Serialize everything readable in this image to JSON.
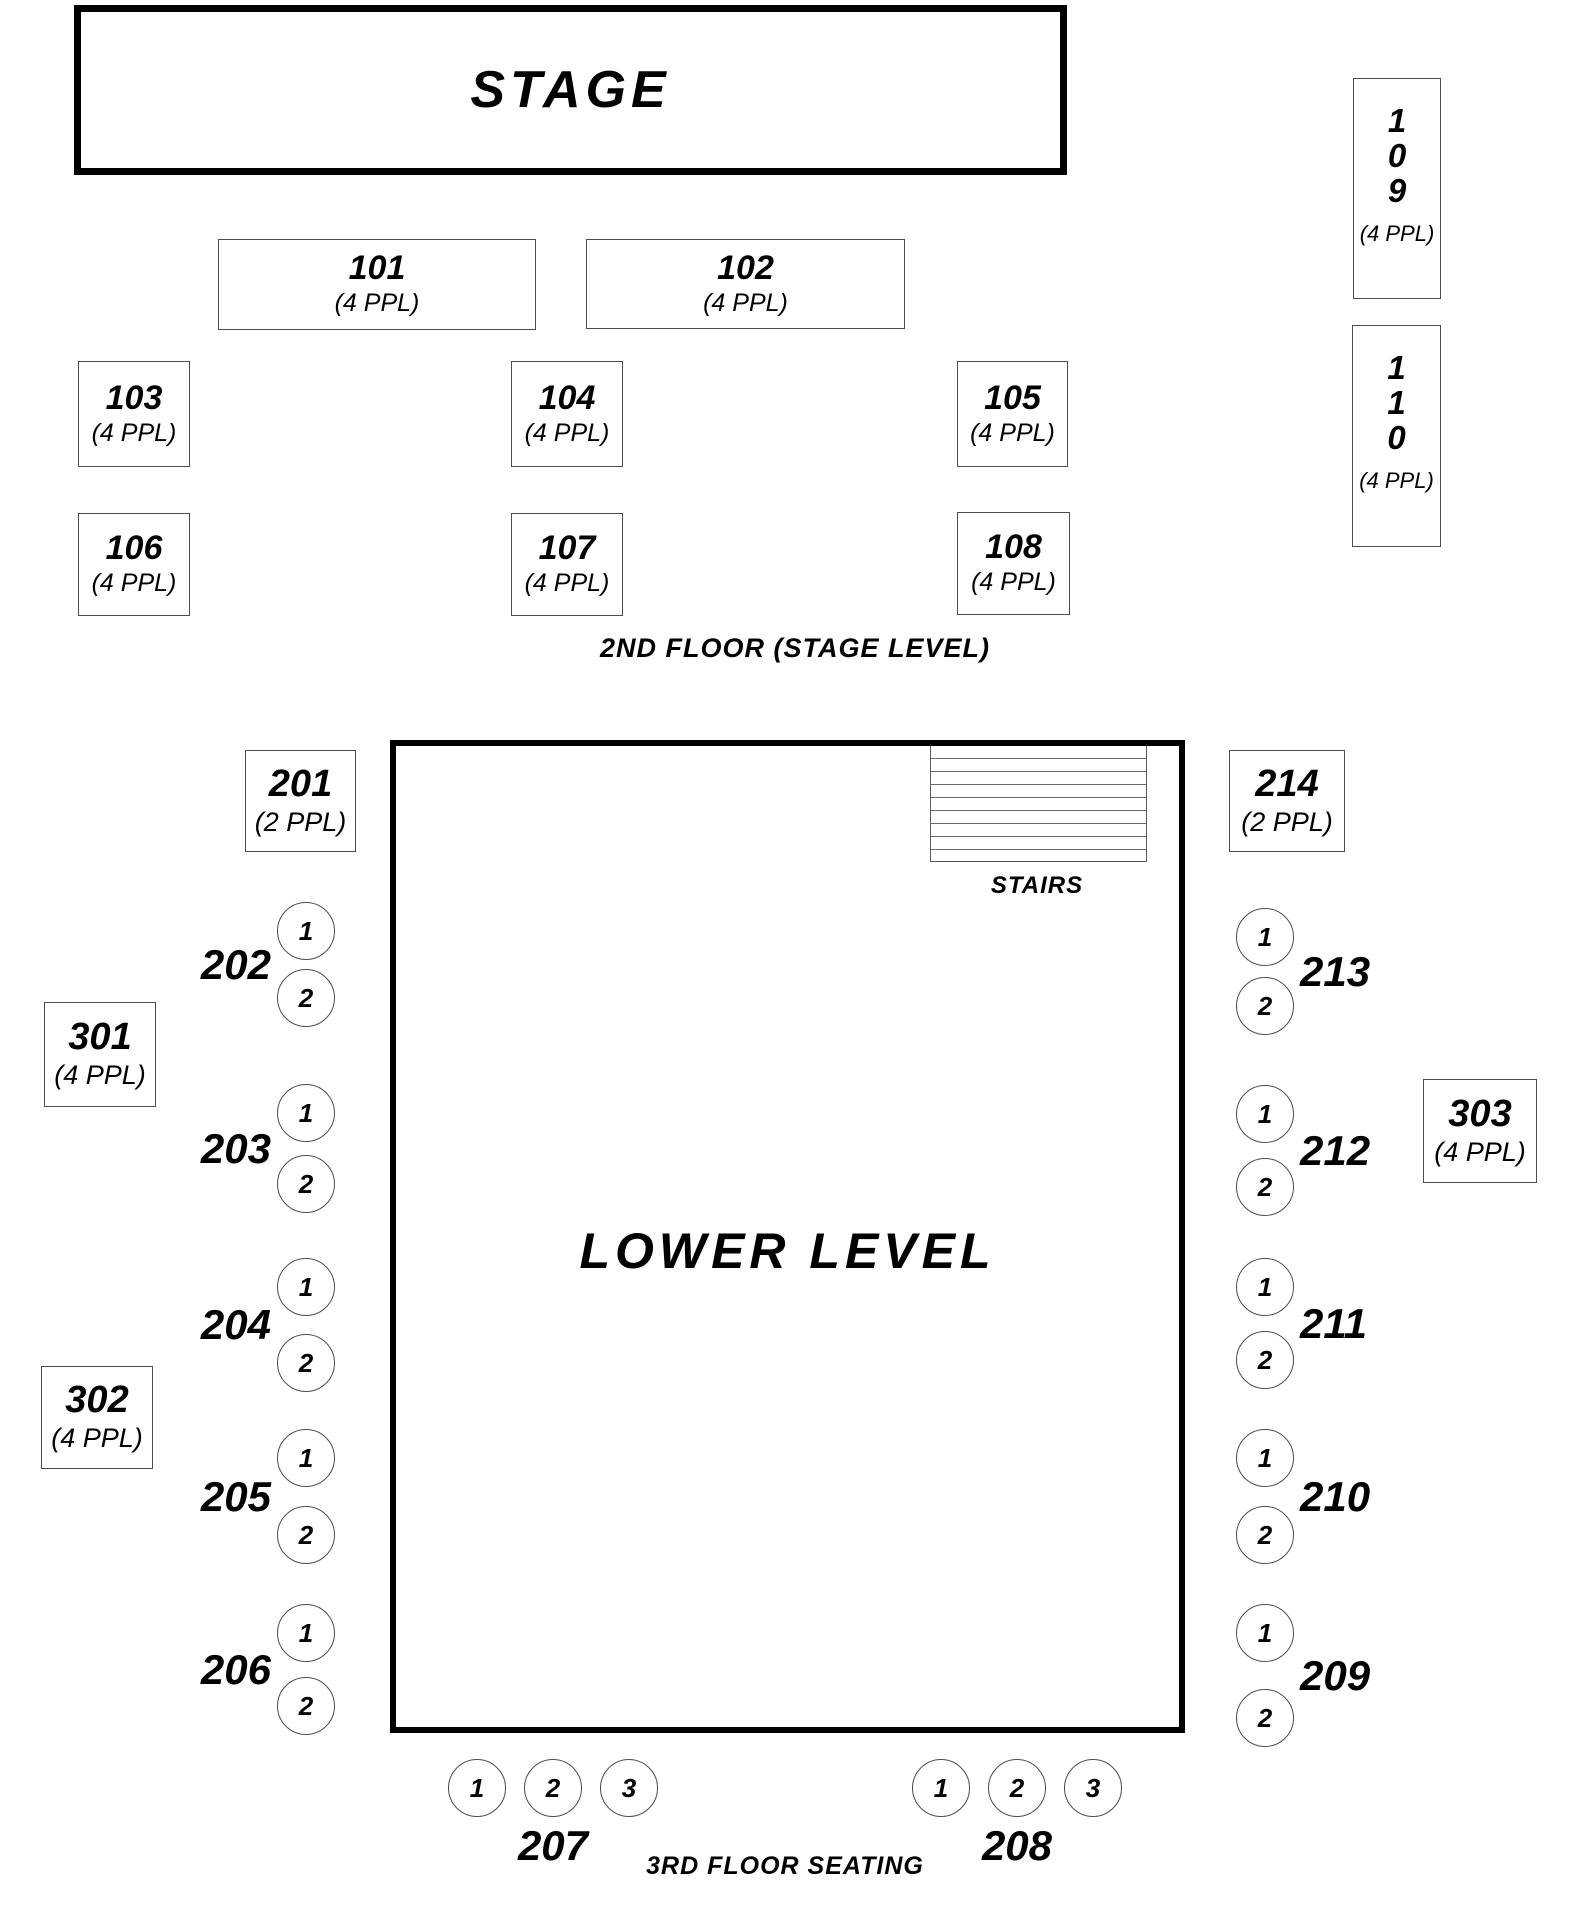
{
  "colors": {
    "ink": "#000000",
    "thick_line": "#000000",
    "thin_line": "#4d4d4d"
  },
  "stage": {
    "label": "STAGE"
  },
  "floor2": {
    "caption": "2ND FLOOR (STAGE LEVEL)",
    "tables": {
      "t101": {
        "id": "101",
        "capacity": "(4 PPL)"
      },
      "t102": {
        "id": "102",
        "capacity": "(4 PPL)"
      },
      "t103": {
        "id": "103",
        "capacity": "(4 PPL)"
      },
      "t104": {
        "id": "104",
        "capacity": "(4 PPL)"
      },
      "t105": {
        "id": "105",
        "capacity": "(4 PPL)"
      },
      "t106": {
        "id": "106",
        "capacity": "(4 PPL)"
      },
      "t107": {
        "id": "107",
        "capacity": "(4 PPL)"
      },
      "t108": {
        "id": "108",
        "capacity": "(4 PPL)"
      },
      "t109": {
        "digits": [
          "1",
          "0",
          "9"
        ],
        "capacity": "(4 PPL)"
      },
      "t110": {
        "digits": [
          "1",
          "1",
          "0"
        ],
        "capacity": "(4 PPL)"
      }
    }
  },
  "lower": {
    "label": "LOWER LEVEL",
    "stairs_label": "STAIRS",
    "tables": {
      "t201": {
        "id": "201",
        "capacity": "(2 PPL)"
      },
      "t214": {
        "id": "214",
        "capacity": "(2 PPL)"
      }
    },
    "rails": {
      "left": [
        {
          "id": "202",
          "seats": [
            "1",
            "2"
          ]
        },
        {
          "id": "203",
          "seats": [
            "1",
            "2"
          ]
        },
        {
          "id": "204",
          "seats": [
            "1",
            "2"
          ]
        },
        {
          "id": "205",
          "seats": [
            "1",
            "2"
          ]
        },
        {
          "id": "206",
          "seats": [
            "1",
            "2"
          ]
        }
      ],
      "right": [
        {
          "id": "213",
          "seats": [
            "1",
            "2"
          ]
        },
        {
          "id": "212",
          "seats": [
            "1",
            "2"
          ]
        },
        {
          "id": "211",
          "seats": [
            "1",
            "2"
          ]
        },
        {
          "id": "210",
          "seats": [
            "1",
            "2"
          ]
        },
        {
          "id": "209",
          "seats": [
            "1",
            "2"
          ]
        }
      ],
      "bottom": [
        {
          "id": "207",
          "seats": [
            "1",
            "2",
            "3"
          ]
        },
        {
          "id": "208",
          "seats": [
            "1",
            "2",
            "3"
          ]
        }
      ]
    }
  },
  "floor3": {
    "caption": "3RD FLOOR SEATING",
    "tables": {
      "t301": {
        "id": "301",
        "capacity": "(4 PPL)"
      },
      "t302": {
        "id": "302",
        "capacity": "(4 PPL)"
      },
      "t303": {
        "id": "303",
        "capacity": "(4 PPL)"
      }
    }
  }
}
